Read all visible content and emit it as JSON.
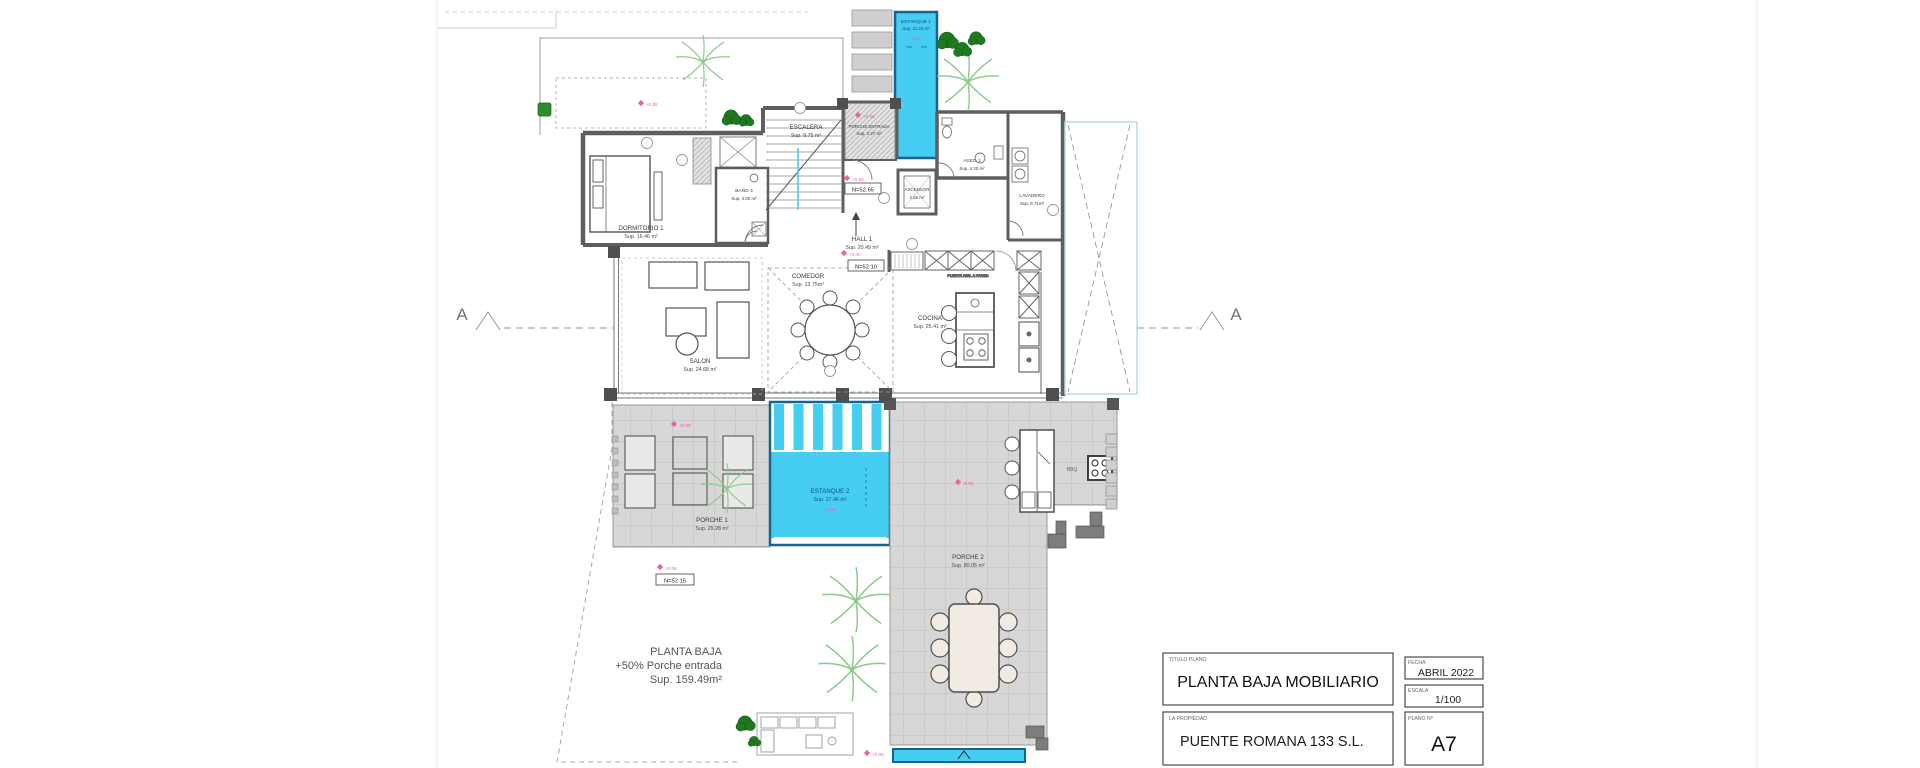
{
  "sheet": {
    "rooms": {
      "estanque1": {
        "name": "ESTANQUE 1",
        "area": "Sup. 11.24 m²"
      },
      "escalera": {
        "name": "ESCALERA",
        "area": "Sup. 9.75 m²"
      },
      "porche_entrada": {
        "name": "PORCHE ENTRADA",
        "area": "Sup. 3.27 m²"
      },
      "dormitorio1": {
        "name": "DORMITORIO 1",
        "area": "Sup. 16.46 m²"
      },
      "bano4": {
        "name": "BAÑO 4",
        "area": "Sup. 4.00 m²"
      },
      "aseo1": {
        "name": "ASEO 1",
        "area": "Sup. 4.20 m²"
      },
      "ascensor": {
        "name": "ASCENSOR",
        "area": "2.56 m²"
      },
      "lavadero": {
        "name": "LAVADERO",
        "area": "Sup. 9.71m²"
      },
      "hall1": {
        "name": "HALL 1",
        "area": "Sup. 20.49 m²"
      },
      "comedor": {
        "name": "COMEDOR",
        "area": "Sup. 13.75m²"
      },
      "salon": {
        "name": "SALON",
        "area": "Sup. 24.68 m²"
      },
      "cocina": {
        "name": "COCINA",
        "area": "Sup. 25.41 m²"
      },
      "estanque2": {
        "name": "ESTANQUE 2",
        "area": "Sup. 27.46 m²"
      },
      "porche1": {
        "name": "PORCHE 1",
        "area": "Sup. 29.28 m²"
      },
      "porche2": {
        "name": "PORCHE 2",
        "area": "Sup. 80.05 m²"
      },
      "bbq": {
        "name": "BBQ"
      }
    },
    "annotations": {
      "n_escalera": "N=52.65",
      "n_hall": "N=52.10",
      "n_exterior": "N=52.15",
      "lv_courtyard": "+0.05",
      "lv_entrada": "+0.55",
      "lv_escalera": "+0.55",
      "lv_hall": "+0.00",
      "lv_porche1": "+0.05",
      "lv_porche2": "-0.05",
      "lv_exterior": "+0.05",
      "lv_bottom": "+0.05",
      "lv_estanque1": "-0.30",
      "lv_estanque2": "-0.30",
      "nota_cocina": "PUERTA RIEL A PARED"
    },
    "section_label": "A",
    "summary": {
      "line1": "PLANTA BAJA",
      "line2": "+50% Porche entrada",
      "line3": "Sup. 159.49m²"
    },
    "title_block": {
      "titulo_label": "TITULO PLANO",
      "titulo": "PLANTA BAJA MOBILIARIO",
      "propiedad_label": "LA PROPIEDAD",
      "propiedad": "PUENTE ROMANA 133 S.L.",
      "fecha_label": "FECHA",
      "fecha": "ABRIL 2022",
      "escala_label": "ESCALA",
      "escala": "1/100",
      "plano_label": "PLANO Nº",
      "plano": "A7"
    },
    "colors": {
      "pool": "#45cdf2",
      "pool_border": "#19638c",
      "wall": "#5e5e5e",
      "porch": "#d7d7d7",
      "annotation_pink": "#ee5fa7",
      "tree_dark": "#1f7a1f",
      "tree_light": "#8cc98c"
    }
  }
}
